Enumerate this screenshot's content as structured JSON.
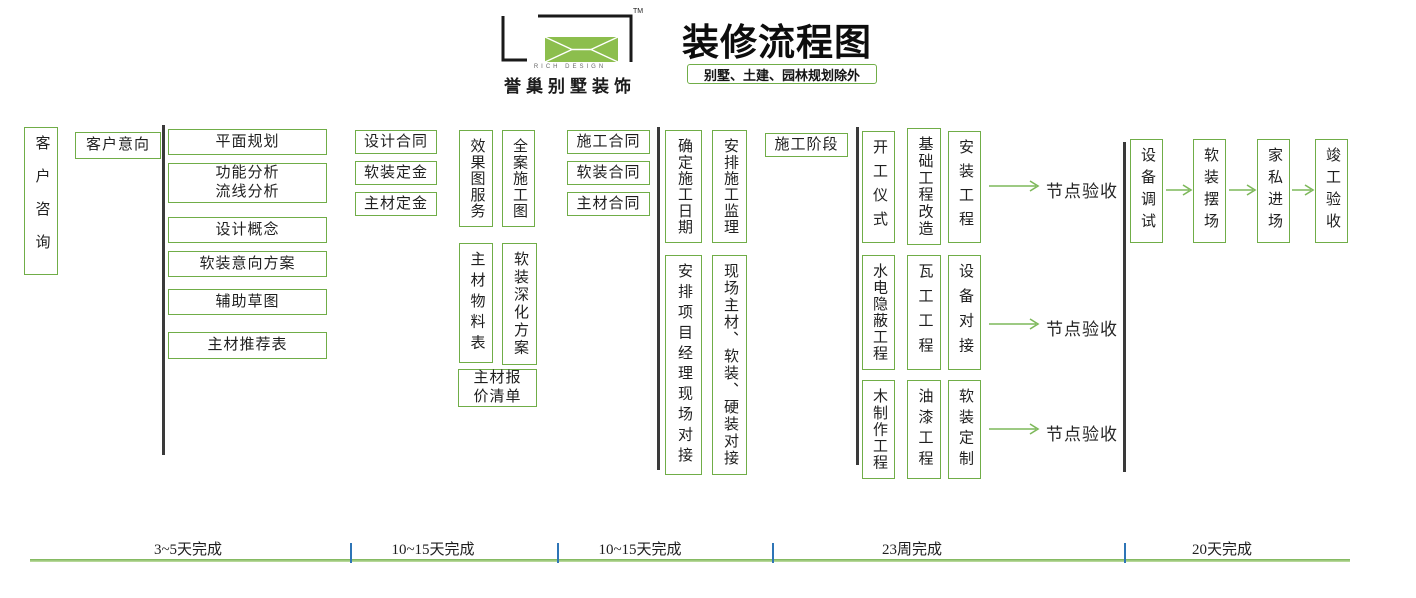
{
  "header": {
    "logo": {
      "tm": "TM",
      "brand_en": "RICH DESIGN",
      "brand_cn": "誉巢别墅装饰"
    },
    "title": "装修流程图",
    "subtitle": "别墅、土建、园林规划除外"
  },
  "colors": {
    "box_green": "#70AD47",
    "logo_green": "#8CBE4D",
    "arrow_green": "#7DB85A",
    "separator_dark": "#3a3a3a",
    "tick_blue": "#2E75B6"
  },
  "flow": {
    "nodes": [
      {
        "id": "customer-consult",
        "text": "客户咨询",
        "orient": "v",
        "x": 24,
        "y": 127,
        "w": 34,
        "h": 148
      },
      {
        "id": "customer-intent",
        "text": "客户意向",
        "orient": "h",
        "x": 75,
        "y": 132,
        "w": 86,
        "h": 27
      },
      {
        "id": "plane-planning",
        "text": "平面规划",
        "orient": "h",
        "x": 168,
        "y": 129,
        "w": 159,
        "h": 26
      },
      {
        "id": "function-flow-analysis",
        "text": "功能分析\n流线分析",
        "orient": "h",
        "x": 168,
        "y": 163,
        "w": 159,
        "h": 40
      },
      {
        "id": "design-concept",
        "text": "设计概念",
        "orient": "h",
        "x": 168,
        "y": 217,
        "w": 159,
        "h": 26
      },
      {
        "id": "soft-intent-plan",
        "text": "软装意向方案",
        "orient": "h",
        "x": 168,
        "y": 251,
        "w": 159,
        "h": 26
      },
      {
        "id": "aux-sketch",
        "text": "辅助草图",
        "orient": "h",
        "x": 168,
        "y": 289,
        "w": 159,
        "h": 26
      },
      {
        "id": "main-material-recommend",
        "text": "主材推荐表",
        "orient": "h",
        "x": 168,
        "y": 332,
        "w": 159,
        "h": 27
      },
      {
        "id": "design-contract",
        "text": "设计合同",
        "orient": "h",
        "x": 355,
        "y": 130,
        "w": 82,
        "h": 24
      },
      {
        "id": "soft-deposit",
        "text": "软装定金",
        "orient": "h",
        "x": 355,
        "y": 161,
        "w": 82,
        "h": 24
      },
      {
        "id": "main-material-deposit",
        "text": "主材定金",
        "orient": "h",
        "x": 355,
        "y": 192,
        "w": 82,
        "h": 24
      },
      {
        "id": "render-service",
        "text": "效果图服务",
        "orient": "v",
        "x": 459,
        "y": 130,
        "w": 34,
        "h": 97
      },
      {
        "id": "full-construction-drawing",
        "text": "全案施工图",
        "orient": "v",
        "x": 502,
        "y": 130,
        "w": 33,
        "h": 97
      },
      {
        "id": "main-material-list",
        "text": "主材物料表",
        "orient": "v",
        "x": 459,
        "y": 243,
        "w": 34,
        "h": 120
      },
      {
        "id": "soft-deepen-plan",
        "text": "软装深化方案",
        "orient": "v",
        "x": 502,
        "y": 243,
        "w": 35,
        "h": 122
      },
      {
        "id": "main-material-quote",
        "text": "主材报\n价清单",
        "orient": "h",
        "x": 458,
        "y": 369,
        "w": 79,
        "h": 38
      },
      {
        "id": "construction-contract",
        "text": "施工合同",
        "orient": "h",
        "x": 567,
        "y": 130,
        "w": 83,
        "h": 24
      },
      {
        "id": "soft-contract",
        "text": "软装合同",
        "orient": "h",
        "x": 567,
        "y": 161,
        "w": 83,
        "h": 24
      },
      {
        "id": "main-material-contract",
        "text": "主材合同",
        "orient": "h",
        "x": 567,
        "y": 192,
        "w": 83,
        "h": 24
      },
      {
        "id": "confirm-construction-date",
        "text": "确定施工日期",
        "orient": "v",
        "x": 665,
        "y": 130,
        "w": 37,
        "h": 113
      },
      {
        "id": "arrange-supervision",
        "text": "安排施工监理",
        "orient": "v",
        "x": 712,
        "y": 130,
        "w": 35,
        "h": 113
      },
      {
        "id": "construction-phase",
        "text": "施工阶段",
        "orient": "h",
        "x": 765,
        "y": 133,
        "w": 83,
        "h": 24
      },
      {
        "id": "arrange-pm-site",
        "text": "安排项目经理现场对接",
        "orient": "v",
        "x": 665,
        "y": 255,
        "w": 37,
        "h": 220
      },
      {
        "id": "site-docking",
        "text": "现场主材、软装、硬装对接",
        "orient": "v",
        "x": 712,
        "y": 255,
        "w": 35,
        "h": 220
      },
      {
        "id": "opening-ceremony",
        "text": "开工仪式",
        "orient": "v",
        "x": 862,
        "y": 131,
        "w": 33,
        "h": 112
      },
      {
        "id": "basic-engineering-renovation",
        "text": "基础工程改造",
        "orient": "v",
        "x": 907,
        "y": 128,
        "w": 34,
        "h": 117
      },
      {
        "id": "installation-engineering",
        "text": "安装工程",
        "orient": "v",
        "x": 948,
        "y": 131,
        "w": 33,
        "h": 112
      },
      {
        "id": "plumbing-concealed-work",
        "text": "水电隐蔽工程",
        "orient": "v",
        "x": 862,
        "y": 255,
        "w": 33,
        "h": 115
      },
      {
        "id": "tiling-work",
        "text": "瓦工工程",
        "orient": "v",
        "x": 907,
        "y": 255,
        "w": 34,
        "h": 115
      },
      {
        "id": "equipment-docking",
        "text": "设备对接",
        "orient": "v",
        "x": 948,
        "y": 255,
        "w": 33,
        "h": 115
      },
      {
        "id": "carpentry-work",
        "text": "木制作工程",
        "orient": "v",
        "x": 862,
        "y": 380,
        "w": 33,
        "h": 99
      },
      {
        "id": "painting-work",
        "text": "油漆工程",
        "orient": "v",
        "x": 907,
        "y": 380,
        "w": 34,
        "h": 99
      },
      {
        "id": "soft-custom",
        "text": "软装定制",
        "orient": "v",
        "x": 948,
        "y": 380,
        "w": 33,
        "h": 99
      },
      {
        "id": "equipment-debug",
        "text": "设备调试",
        "orient": "v",
        "x": 1130,
        "y": 139,
        "w": 33,
        "h": 104
      },
      {
        "id": "soft-staging",
        "text": "软装摆场",
        "orient": "v",
        "x": 1193,
        "y": 139,
        "w": 33,
        "h": 104
      },
      {
        "id": "furniture-entry",
        "text": "家私进场",
        "orient": "v",
        "x": 1257,
        "y": 139,
        "w": 33,
        "h": 104
      },
      {
        "id": "completion-acceptance",
        "text": "竣工验收",
        "orient": "v",
        "x": 1315,
        "y": 139,
        "w": 33,
        "h": 104
      }
    ],
    "separators": [
      {
        "x": 162,
        "y1": 125,
        "y2": 455
      },
      {
        "x": 657,
        "y1": 127,
        "y2": 470
      },
      {
        "x": 856,
        "y1": 127,
        "y2": 465
      },
      {
        "x": 1123,
        "y1": 142,
        "y2": 472
      }
    ],
    "arrows": [
      {
        "x1": 989,
        "x2": 1038,
        "y": 186
      },
      {
        "x1": 989,
        "x2": 1038,
        "y": 324
      },
      {
        "x1": 989,
        "x2": 1038,
        "y": 429
      },
      {
        "x1": 1166,
        "x2": 1191,
        "y": 190
      },
      {
        "x1": 1229,
        "x2": 1255,
        "y": 190
      },
      {
        "x1": 1292,
        "x2": 1313,
        "y": 190
      }
    ],
    "checkpoints": [
      {
        "label": "节点验收",
        "x": 1046,
        "y": 177
      },
      {
        "label": "节点验收",
        "x": 1046,
        "y": 315
      },
      {
        "label": "节点验收",
        "x": 1046,
        "y": 420
      }
    ]
  },
  "timeline": {
    "line": {
      "x1": 30,
      "x2": 1350,
      "y": 560
    },
    "ticks": [
      {
        "x": 350
      },
      {
        "x": 557
      },
      {
        "x": 772
      },
      {
        "x": 1124
      }
    ],
    "segments": [
      {
        "label": "3~5天完成",
        "cx": 188
      },
      {
        "label": "10~15天完成",
        "cx": 433
      },
      {
        "label": "10~15天完成",
        "cx": 640
      },
      {
        "label": "23周完成",
        "cx": 912
      },
      {
        "label": "20天完成",
        "cx": 1222
      }
    ]
  }
}
